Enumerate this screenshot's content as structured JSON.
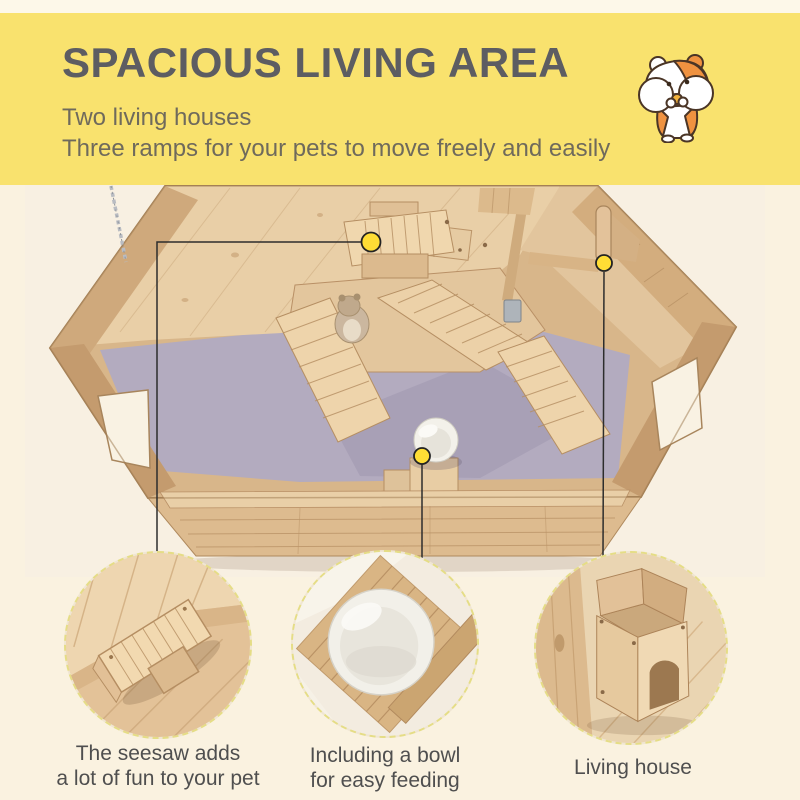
{
  "page": {
    "background_color": "#faf2e0",
    "top_strip_color": "#fdf8e9"
  },
  "banner": {
    "background_color": "#f9e26e",
    "title": "SPACIOUS LIVING AREA",
    "title_color": "#5d5d62",
    "subtitle_lines": [
      "Two living houses",
      "Three ramps for your pets to move freely and easily"
    ],
    "subtitle_color": "#6f6a5c",
    "mascot_icon": "hamster-icon"
  },
  "photo": {
    "subject": "wooden hamster cage, top view",
    "callout_dot_color": "#ffdd35",
    "callout_line_color": "#2d2d2d",
    "wood_color": "#dcba8e",
    "floor_color": "#b3abbf"
  },
  "details": [
    {
      "name": "seesaw",
      "caption_lines": [
        "The seesaw adds",
        "a lot of fun to your pet"
      ]
    },
    {
      "name": "bowl",
      "caption_lines": [
        "Including a bowl",
        "for easy feeding"
      ]
    },
    {
      "name": "living-house",
      "caption_lines": [
        "Living house"
      ]
    }
  ],
  "circle_border_color": "#e5dd86"
}
